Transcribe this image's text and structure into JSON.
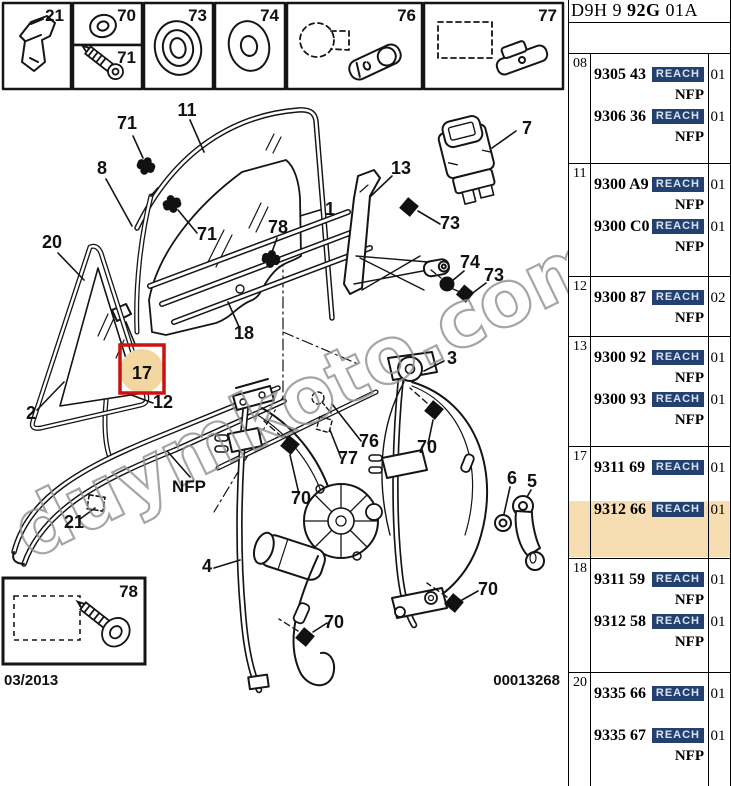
{
  "header": {
    "code_prefix": "D9H 9 ",
    "code_bold": "92G",
    "code_suffix": " 01A"
  },
  "table": {
    "reach_label": "REACH",
    "groups": [
      {
        "id": "08",
        "rows": [
          {
            "part": "9305 43",
            "qty": "01",
            "nfp": "NFP"
          },
          {
            "part": "9306 36",
            "qty": "01",
            "nfp": "NFP"
          }
        ]
      },
      {
        "id": "11",
        "rows": [
          {
            "part": "9300 A9",
            "qty": "01",
            "nfp": "NFP"
          },
          {
            "part": "9300 C0",
            "qty": "01",
            "nfp": "NFP"
          }
        ]
      },
      {
        "id": "12",
        "rows": [
          {
            "part": "9300 87",
            "qty": "02",
            "nfp": "NFP"
          }
        ]
      },
      {
        "id": "13",
        "rows": [
          {
            "part": "9300 92",
            "qty": "01",
            "nfp": "NFP"
          },
          {
            "part": "9300 93",
            "qty": "01",
            "nfp": "NFP"
          }
        ]
      },
      {
        "id": "17",
        "rows": [
          {
            "part": "9311 69",
            "qty": "01"
          },
          {
            "part": "9312 66",
            "qty": "01",
            "highlighted": true
          }
        ]
      },
      {
        "id": "18",
        "rows": [
          {
            "part": "9311 59",
            "qty": "01",
            "nfp": "NFP"
          },
          {
            "part": "9312 58",
            "qty": "01",
            "nfp": "NFP"
          }
        ]
      },
      {
        "id": "20",
        "rows": [
          {
            "part": "9335 66",
            "qty": "01"
          },
          {
            "part": "9335 67",
            "qty": "01",
            "nfp": "NFP"
          }
        ]
      }
    ]
  },
  "legend": {
    "cells": [
      {
        "number": "21"
      },
      {
        "number": "70"
      },
      {
        "number": "71"
      },
      {
        "number": "73"
      },
      {
        "number": "74"
      },
      {
        "number": "76"
      },
      {
        "number": "77"
      }
    ],
    "bottom_cell": {
      "number": "78"
    }
  },
  "diagram": {
    "highlight_label": "17",
    "nfp_note": "NFP",
    "callouts": {
      "c71a": "71",
      "c11": "11",
      "c8": "8",
      "c1": "1",
      "c71b": "71",
      "c78": "78",
      "c13": "13",
      "c7": "7",
      "c73a": "73",
      "c74": "74",
      "c73b": "73",
      "c20": "20",
      "c2": "2",
      "c18": "18",
      "c12": "12",
      "c21": "21",
      "c4": "4",
      "c70a": "70",
      "c76": "76",
      "c77": "77",
      "c70b": "70",
      "c3": "3",
      "c6": "6",
      "c5": "5",
      "c70c": "70",
      "c70d": "70"
    }
  },
  "footer": {
    "date": "03/2013",
    "doc_number": "00013268"
  },
  "watermark": {
    "text": "duymkoto.com"
  },
  "colors": {
    "reach_bg": "#23406e",
    "reach_text": "#d8e4f4",
    "highlight": "#f6deb2",
    "red_box": "#cc1111",
    "tan_circle": "#f2d7a0"
  }
}
